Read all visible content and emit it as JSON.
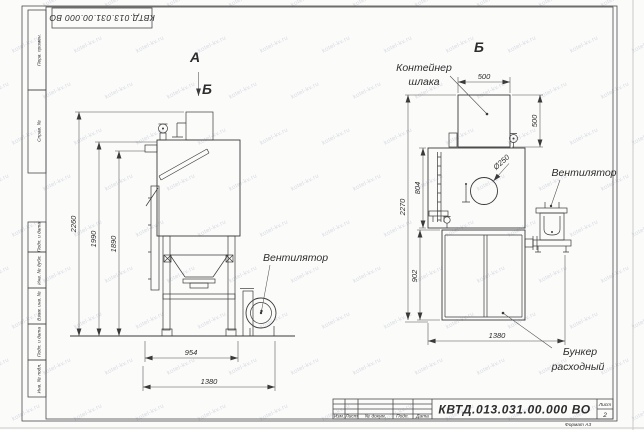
{
  "watermark": {
    "text": "kotel-kv.ru"
  },
  "stamps": {
    "top_left_doc_number": "КВТД.013.031.00.000  ВО"
  },
  "frame_fields": {
    "perv_primen": "Перв. примен.",
    "sprav_n": "Справ. №",
    "podp_data_1": "Подп. и дата",
    "inv_dubl": "Инв. № дубл.",
    "vzam_inv": "Взам. инв. №",
    "podp_data_2": "Подп. и дата",
    "inv_podl": "Инв. № подл."
  },
  "title_block": {
    "col_izm": "Изм.",
    "col_list": "Лист",
    "col_doc": "№ докум.",
    "col_podp": "Подп.",
    "col_data": "Дата",
    "doc_number": "КВТД.013.031.00.000  ВО",
    "sheet_label": "Лист",
    "sheet_number": "2",
    "format_note": "Формат А3"
  },
  "view_front": {
    "label_a": "А",
    "label_b": "Б",
    "dim_2260": "2260",
    "dim_1990": "1990",
    "dim_1890": "1890",
    "dim_954": "954",
    "dim_1380": "1380",
    "fan_label": "Вентилятор"
  },
  "view_side": {
    "label": "Б",
    "container_line1": "Контейнер",
    "container_line2": "шлака",
    "dim_500w": "500",
    "dim_500h": "500",
    "dim_2270": "2270",
    "dim_804": "804",
    "dim_902": "902",
    "dim_1380": "1380",
    "dim_d250": "Ø250",
    "fan_label": "Вентилятор",
    "hopper_line1": "Бункер",
    "hopper_line2": "расходный"
  }
}
